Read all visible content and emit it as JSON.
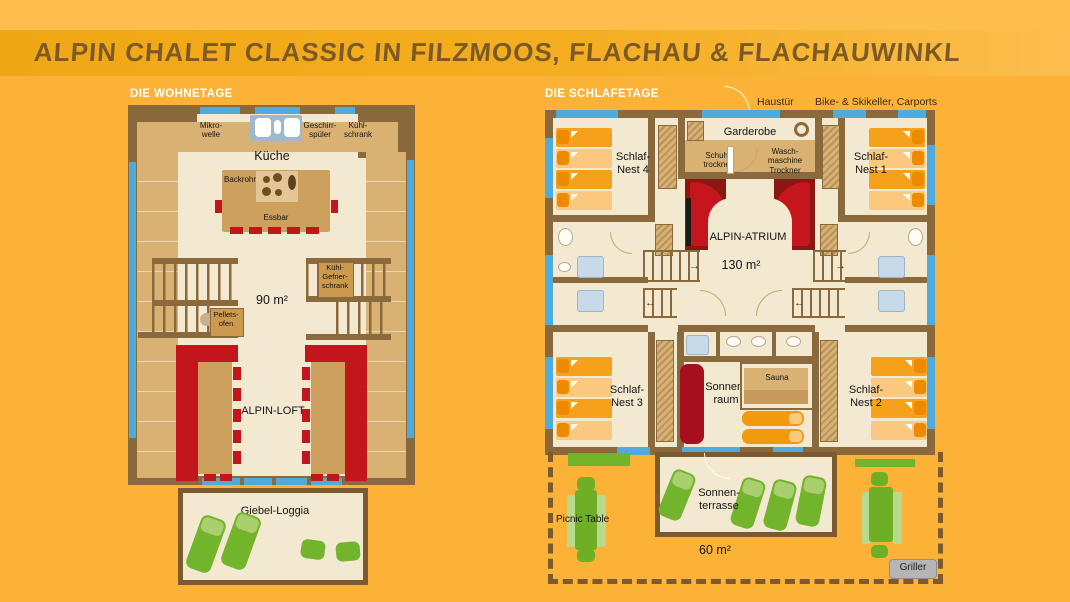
{
  "title": "ALPIN CHALET CLASSIC IN FILZMOOS, FLACHAU & FLACHAUWINKL",
  "colors": {
    "background_orange": "#FBB237",
    "title_band_orange": "#F2A918",
    "wall_brown": "#8A6A3C",
    "window_blue": "#4FABDC",
    "floor_cream": "#F3E8D0",
    "furniture_tan": "#D9B273",
    "sofa_red": "#C3161C",
    "atrium_dark_red": "#8C1710",
    "bed_orange": "#F5A11C",
    "garden_green": "#72B42B",
    "griller_gray": "#B5B5B5"
  },
  "wohnetage": {
    "heading": "DIE WOHNETAGE",
    "labels": {
      "mikrowelle": "Mikro-\nwelle",
      "geschirrspueler": "Geschirr-\nspüler",
      "kuehlschrank": "Kühl-\nschrank",
      "kueche": "Küche",
      "backrohr": "Backrohr",
      "essbar": "Essbar",
      "area": "90 m²",
      "kuehlgefrier": "Kühl-\nGefrier-\nschrank",
      "pelletsofen": "Pellets-\nofen",
      "loft": "ALPIN-LOFT",
      "loggia": "Giebel-Loggia"
    }
  },
  "schlafetage": {
    "heading": "DIE SCHLAFETAGE",
    "exterior": {
      "haustuer": "Haustür",
      "keller": "Bike- & Skikeller, Carports"
    },
    "labels": {
      "garderobe": "Garderobe",
      "schuhtrockner": "Schuh-\ntrockner",
      "waschmaschine": "Wasch-\nmaschine\nTrockner",
      "nest4": "Schlaf-\nNest 4",
      "nest1": "Schlaf-\nNest 1",
      "nest3": "Schlaf-\nNest 3",
      "nest2": "Schlaf-\nNest 2",
      "atrium": "ALPIN-ATRIUM",
      "area": "130 m²",
      "sonnenraum": "Sonnen-\nraum",
      "sauna": "Sauna",
      "terrasse": "Sonnen-\nterrasse",
      "picnic": "Picnic Table",
      "terrace_area": "60 m²",
      "griller": "Griller"
    }
  }
}
